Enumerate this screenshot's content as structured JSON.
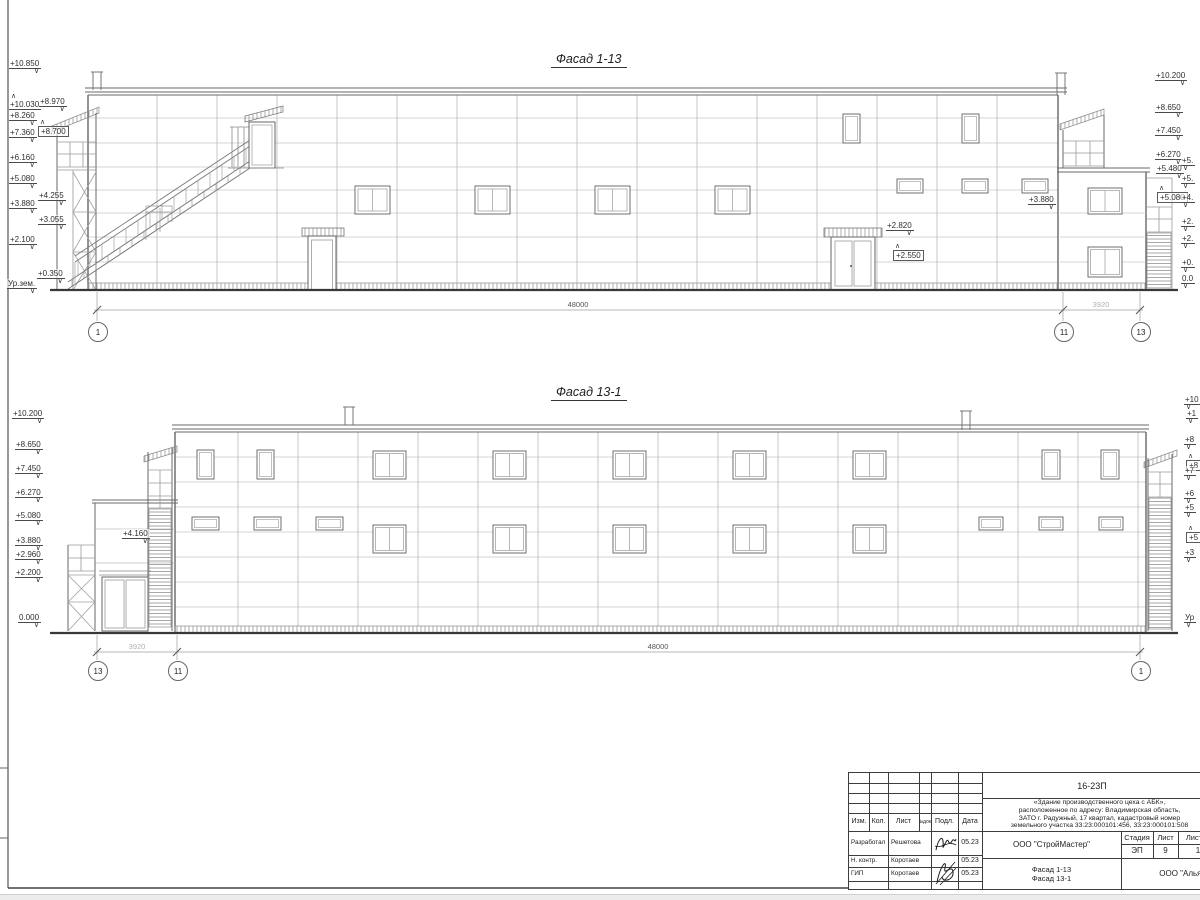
{
  "top": {
    "title": "Фасад 1-13",
    "marks_left": [
      "+10.850",
      "+10.030",
      "+8.970",
      "+8.260",
      "+8.700",
      "+7.360",
      "+6.160",
      "+5.080",
      "+4.255",
      "+3.880",
      "+3.055",
      "+2.100",
      "+0.350",
      "Ур.зем."
    ],
    "marks_right": [
      "+10.200",
      "+8.650",
      "+7.450",
      "+6.270",
      "+5.480",
      "+5.080"
    ],
    "marks_edge": [
      "+5.",
      "+5.",
      "+4.",
      "+2.",
      "+2.",
      "+0.",
      "0.0"
    ],
    "marks_inner": [
      "+2.820",
      "+2.550",
      "+3.880"
    ],
    "dim_main": "48000",
    "dim_side": "3920",
    "axes": [
      "1",
      "11",
      "13"
    ]
  },
  "bottom": {
    "title": "Фасад 13-1",
    "marks_left": [
      "+10.200",
      "+8.650",
      "+7.450",
      "+6.270",
      "+5.080",
      "+4.160",
      "+3.880",
      "+2.960",
      "+2.200",
      "0.000"
    ],
    "marks_edge": [
      "+10",
      "+1",
      "+8",
      "+8",
      "+7",
      "+6",
      "+5",
      "+5",
      "+3",
      "Ур"
    ],
    "dim_main": "48000",
    "dim_side": "3920",
    "axes": [
      "13",
      "11",
      "1"
    ]
  },
  "title_block": {
    "doc_number": "16-23П",
    "description": [
      "«Здание производственного цеха с АБК»,",
      "расположенное по адресу: Владимирская область,",
      "ЗАТО г. Радужный, 17 квартал, кадастровый номер",
      "земельного участка 33:23:000101:456, 33:23:000101:508"
    ],
    "cols": {
      "izm": "Изм.",
      "kol": "Кол.",
      "list": "Лист",
      "ndok": "№док.",
      "podl": "Подл.",
      "data": "Дата"
    },
    "rows": [
      {
        "role": "Разработал",
        "name": "Решетова",
        "date": "05.23"
      },
      {
        "role": "Н. контр.",
        "name": "Коротаев",
        "date": "05.23"
      },
      {
        "role": "ГИП",
        "name": "Коротаев",
        "date": "05.23"
      }
    ],
    "designer_org": "ООО \"СтройМастер\"",
    "stage_label": "Стадия",
    "sheet_label": "Лист",
    "sheets_label": "Листов",
    "stage": "ЭП",
    "sheet_num": "9",
    "sheets_total": "1",
    "subject": [
      "Фасад 1-13",
      "Фасад 13-1"
    ],
    "client_org": "ООО \"Альянс\""
  }
}
